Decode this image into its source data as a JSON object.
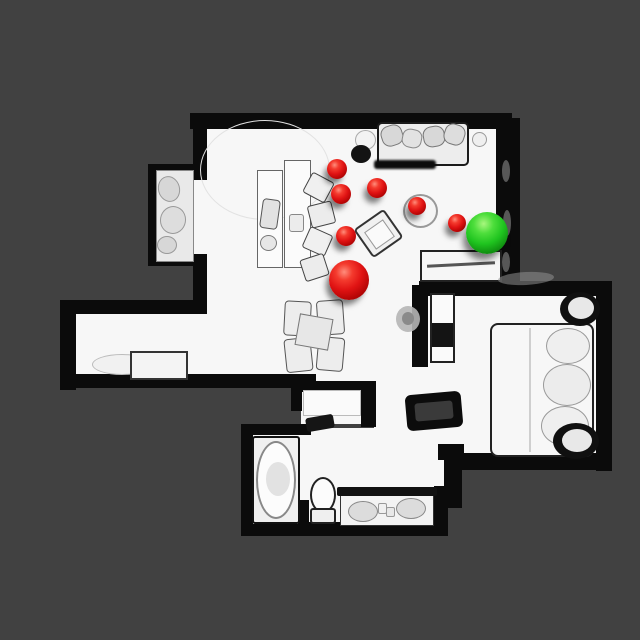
{
  "scene": {
    "type": "top-down-3d-scan-floorplan",
    "background_color": "#414141",
    "floor_color": "#f7f7f7",
    "wall_color": "#0b0b0b",
    "marker_red_color": "#e01313",
    "marker_green_color": "#1fc41f"
  },
  "markers": [
    {
      "name": "waypoint-red-1",
      "color": "red",
      "x": 337,
      "y": 169,
      "r": 10
    },
    {
      "name": "waypoint-red-2",
      "color": "red",
      "x": 341,
      "y": 194,
      "r": 10
    },
    {
      "name": "waypoint-red-3",
      "color": "red",
      "x": 377,
      "y": 188,
      "r": 10
    },
    {
      "name": "waypoint-red-4",
      "color": "red",
      "x": 417,
      "y": 206,
      "r": 9
    },
    {
      "name": "waypoint-red-5",
      "color": "red",
      "x": 457,
      "y": 223,
      "r": 9
    },
    {
      "name": "waypoint-red-6",
      "color": "red",
      "x": 346,
      "y": 236,
      "r": 10
    },
    {
      "name": "waypoint-red-large",
      "color": "red",
      "x": 349,
      "y": 280,
      "r": 20
    },
    {
      "name": "waypoint-green-goal",
      "color": "green",
      "x": 487,
      "y": 233,
      "r": 21
    }
  ],
  "floors": [
    {
      "name": "living-room-floor",
      "x": 198,
      "y": 126,
      "w": 302,
      "h": 256
    },
    {
      "name": "closet-alcove-floor",
      "x": 152,
      "y": 170,
      "w": 46,
      "h": 90
    },
    {
      "name": "hallway-floor",
      "x": 76,
      "y": 312,
      "w": 130,
      "h": 64
    },
    {
      "name": "bedroom-floor",
      "x": 426,
      "y": 294,
      "w": 172,
      "h": 162
    },
    {
      "name": "corridor-floor",
      "x": 374,
      "y": 378,
      "w": 82,
      "h": 84
    },
    {
      "name": "bathroom-floor",
      "x": 300,
      "y": 428,
      "w": 150,
      "h": 78
    },
    {
      "name": "vanity-nook-floor",
      "x": 336,
      "y": 488,
      "w": 100,
      "h": 40
    },
    {
      "name": "tub-room-floor",
      "x": 248,
      "y": 430,
      "w": 100,
      "h": 98
    },
    {
      "name": "closet-room-floor",
      "x": 301,
      "y": 388,
      "w": 64,
      "h": 36
    }
  ],
  "walls": [
    {
      "name": "wall-top",
      "x": 190,
      "y": 113,
      "w": 322,
      "h": 16
    },
    {
      "name": "wall-right-upper",
      "x": 496,
      "y": 118,
      "w": 24,
      "h": 170
    },
    {
      "name": "wall-left-upper",
      "x": 193,
      "y": 118,
      "w": 14,
      "h": 62
    },
    {
      "name": "wall-alcove-top",
      "x": 150,
      "y": 164,
      "w": 50,
      "h": 10
    },
    {
      "name": "wall-alcove-left",
      "x": 148,
      "y": 164,
      "w": 8,
      "h": 102
    },
    {
      "name": "wall-alcove-bottom",
      "x": 150,
      "y": 256,
      "w": 50,
      "h": 10
    },
    {
      "name": "wall-left-mid",
      "x": 193,
      "y": 254,
      "w": 14,
      "h": 60
    },
    {
      "name": "wall-hallway-top",
      "x": 64,
      "y": 300,
      "w": 132,
      "h": 14
    },
    {
      "name": "wall-hallway-left",
      "x": 60,
      "y": 300,
      "w": 16,
      "h": 90
    },
    {
      "name": "wall-hallway-bottom",
      "x": 64,
      "y": 374,
      "w": 252,
      "h": 14
    },
    {
      "name": "wall-closetroom-top",
      "x": 291,
      "y": 381,
      "w": 84,
      "h": 11
    },
    {
      "name": "wall-closetroom-right",
      "x": 361,
      "y": 381,
      "w": 15,
      "h": 46
    },
    {
      "name": "wall-closetroom-left",
      "x": 291,
      "y": 381,
      "w": 11,
      "h": 30
    },
    {
      "name": "wall-bedroom-top",
      "x": 419,
      "y": 281,
      "w": 190,
      "h": 15
    },
    {
      "name": "wall-bedroom-right",
      "x": 596,
      "y": 281,
      "w": 16,
      "h": 190
    },
    {
      "name": "wall-bedroom-left",
      "x": 412,
      "y": 285,
      "w": 16,
      "h": 82
    },
    {
      "name": "wall-bedroom-bottom",
      "x": 450,
      "y": 453,
      "w": 154,
      "h": 17
    },
    {
      "name": "wall-bedroom-step",
      "x": 438,
      "y": 444,
      "w": 26,
      "h": 16
    },
    {
      "name": "wall-tub-top",
      "x": 243,
      "y": 424,
      "w": 68,
      "h": 11
    },
    {
      "name": "wall-tub-left",
      "x": 241,
      "y": 424,
      "w": 12,
      "h": 112
    },
    {
      "name": "wall-tub-bottom",
      "x": 241,
      "y": 524,
      "w": 112,
      "h": 12
    },
    {
      "name": "wall-toilet-left",
      "x": 298,
      "y": 500,
      "w": 11,
      "h": 32
    },
    {
      "name": "wall-toilet-bottom",
      "x": 298,
      "y": 522,
      "w": 48,
      "h": 12
    },
    {
      "name": "wall-vanity-bottom",
      "x": 336,
      "y": 524,
      "w": 112,
      "h": 12
    },
    {
      "name": "wall-vanity-right",
      "x": 434,
      "y": 486,
      "w": 14,
      "h": 50
    },
    {
      "name": "wall-bath-right",
      "x": 444,
      "y": 448,
      "w": 18,
      "h": 60
    }
  ],
  "furniture": [
    {
      "name": "floor-arc",
      "x": 200,
      "y": 120,
      "w": 130,
      "h": 100,
      "kind": "ellipse",
      "fill": "transparent",
      "border": "1px solid #e2e2e2"
    },
    {
      "name": "sofa",
      "x": 377,
      "y": 122,
      "w": 92,
      "h": 44,
      "fill": "#ededed",
      "border": "2px solid #1b1b1b",
      "radius": 5
    },
    {
      "name": "sofa-cushion",
      "x": 381,
      "y": 125,
      "w": 22,
      "h": 21,
      "fill": "#d8d8d8",
      "border": "1px solid #777",
      "radius": "40%",
      "rotate": -18
    },
    {
      "name": "sofa-cushion",
      "x": 402,
      "y": 129,
      "w": 20,
      "h": 19,
      "fill": "#e2e2e2",
      "border": "1px solid #888",
      "radius": "40%",
      "rotate": 12
    },
    {
      "name": "sofa-cushion",
      "x": 423,
      "y": 126,
      "w": 22,
      "h": 21,
      "fill": "#d8d8d8",
      "border": "1px solid #777",
      "radius": "40%",
      "rotate": -10
    },
    {
      "name": "sofa-cushion",
      "x": 444,
      "y": 124,
      "w": 21,
      "h": 21,
      "fill": "#dddddd",
      "border": "1px solid #777",
      "radius": "40%",
      "rotate": 18
    },
    {
      "name": "sofa-shadow",
      "x": 374,
      "y": 160,
      "w": 62,
      "h": 9,
      "fill": "#0d0d0d",
      "blur": 1,
      "radius": 3
    },
    {
      "name": "side-knob",
      "x": 472,
      "y": 132,
      "w": 15,
      "h": 15,
      "kind": "ellipse",
      "fill": "#efefef",
      "border": "1px solid #999"
    },
    {
      "name": "floor-lamp-globe",
      "x": 355,
      "y": 130,
      "w": 21,
      "h": 20,
      "kind": "ellipse",
      "fill": "#f3f3f3",
      "border": "1px solid #aaa"
    },
    {
      "name": "floor-lamp-shadow",
      "x": 351,
      "y": 145,
      "w": 20,
      "h": 18,
      "kind": "ellipse",
      "fill": "#131313"
    },
    {
      "name": "desk-panel",
      "x": 257,
      "y": 170,
      "w": 26,
      "h": 98,
      "fill": "#fbfbfb",
      "border": "1px solid #666"
    },
    {
      "name": "desk-panel",
      "x": 284,
      "y": 160,
      "w": 27,
      "h": 108,
      "fill": "#fbfbfb",
      "border": "1px solid #666"
    },
    {
      "name": "desk-chair",
      "x": 261,
      "y": 199,
      "w": 18,
      "h": 30,
      "fill": "#e2e2e2",
      "border": "1px solid #555",
      "radius": 4,
      "rotate": 8
    },
    {
      "name": "desk-item",
      "x": 289,
      "y": 214,
      "w": 15,
      "h": 18,
      "fill": "#ececec",
      "border": "1px solid #888",
      "radius": 3
    },
    {
      "name": "desk-item-round",
      "x": 260,
      "y": 235,
      "w": 17,
      "h": 16,
      "kind": "ellipse",
      "fill": "#e6e6e6",
      "border": "1px solid #777"
    },
    {
      "name": "office-chair",
      "x": 306,
      "y": 176,
      "w": 25,
      "h": 23,
      "fill": "#f0f0f0",
      "border": "1px solid #444",
      "radius": 3,
      "rotate": 28
    },
    {
      "name": "office-chair",
      "x": 309,
      "y": 203,
      "w": 25,
      "h": 23,
      "fill": "#ececec",
      "border": "1px solid #444",
      "radius": 3,
      "rotate": -14
    },
    {
      "name": "office-chair",
      "x": 305,
      "y": 230,
      "w": 25,
      "h": 23,
      "fill": "#f0f0f0",
      "border": "1px solid #444",
      "radius": 3,
      "rotate": 24
    },
    {
      "name": "office-chair",
      "x": 302,
      "y": 256,
      "w": 25,
      "h": 23,
      "fill": "#ececec",
      "border": "1px solid #444",
      "radius": 3,
      "rotate": -18
    },
    {
      "name": "round-side-table",
      "x": 403,
      "y": 194,
      "w": 35,
      "h": 34,
      "kind": "ellipse",
      "fill": "#f5f5f5",
      "border": "2px solid #999"
    },
    {
      "name": "armchair",
      "x": 360,
      "y": 216,
      "w": 37,
      "h": 35,
      "fill": "#f1f1f1",
      "border": "2px solid #333",
      "radius": 4,
      "rotate": -35
    },
    {
      "name": "armchair-seat",
      "x": 368,
      "y": 224,
      "w": 23,
      "h": 21,
      "fill": "#fafafa",
      "border": "1px solid #999",
      "rotate": -35
    },
    {
      "name": "dining-chair",
      "x": 284,
      "y": 301,
      "w": 27,
      "h": 35,
      "fill": "#ededed",
      "border": "1px solid #555",
      "radius": 4,
      "rotate": 3
    },
    {
      "name": "dining-chair",
      "x": 317,
      "y": 300,
      "w": 27,
      "h": 35,
      "fill": "#ededed",
      "border": "1px solid #555",
      "radius": 4,
      "rotate": -4
    },
    {
      "name": "dining-chair",
      "x": 285,
      "y": 338,
      "w": 27,
      "h": 34,
      "fill": "#ededed",
      "border": "1px solid #555",
      "radius": 4,
      "rotate": -6
    },
    {
      "name": "dining-chair",
      "x": 317,
      "y": 337,
      "w": 27,
      "h": 34,
      "fill": "#ededed",
      "border": "1px solid #555",
      "radius": 4,
      "rotate": 5
    },
    {
      "name": "dining-table",
      "x": 297,
      "y": 316,
      "w": 34,
      "h": 32,
      "fill": "#e7e7e7",
      "border": "1px solid #777",
      "rotate": 10
    },
    {
      "name": "console-table",
      "x": 420,
      "y": 250,
      "w": 82,
      "h": 32,
      "fill": "#f6f6f6",
      "border": "2px solid #222"
    },
    {
      "name": "console-stick",
      "x": 427,
      "y": 263,
      "w": 68,
      "h": 3,
      "fill": "#555",
      "rotate": -3
    },
    {
      "name": "alcove-shelf",
      "x": 156,
      "y": 170,
      "w": 38,
      "h": 92,
      "fill": "#e9e9e9",
      "border": "1px solid #888"
    },
    {
      "name": "alcove-item",
      "x": 158,
      "y": 176,
      "w": 22,
      "h": 26,
      "kind": "ellipse",
      "fill": "#d7d7d7",
      "border": "1px solid #999",
      "rotate": -15
    },
    {
      "name": "alcove-item",
      "x": 160,
      "y": 206,
      "w": 26,
      "h": 28,
      "kind": "ellipse",
      "fill": "#dddddd",
      "border": "1px solid #999",
      "rotate": 10
    },
    {
      "name": "alcove-item",
      "x": 157,
      "y": 236,
      "w": 20,
      "h": 18,
      "kind": "ellipse",
      "fill": "#d7d7d7",
      "border": "1px solid #999"
    },
    {
      "name": "hallway-rug",
      "x": 92,
      "y": 354,
      "w": 60,
      "h": 21,
      "kind": "ellipse",
      "fill": "#f1f1f1",
      "border": "1px solid #bbb"
    },
    {
      "name": "hallway-bench",
      "x": 130,
      "y": 351,
      "w": 58,
      "h": 29,
      "fill": "#f4f4f4",
      "border": "2px solid #333",
      "class": "quilt"
    },
    {
      "name": "bed",
      "x": 490,
      "y": 323,
      "w": 104,
      "h": 134,
      "fill": "#f7f7f7",
      "border": "2px solid #222",
      "radius": 8
    },
    {
      "name": "bed-fold-line",
      "x": 529,
      "y": 328,
      "w": 2,
      "h": 124,
      "fill": "#cfcfcf"
    },
    {
      "name": "bed-pillow",
      "x": 546,
      "y": 328,
      "w": 44,
      "h": 36,
      "kind": "ellipse",
      "fill": "#efefef",
      "border": "1px solid #999"
    },
    {
      "name": "bed-pillow",
      "x": 543,
      "y": 364,
      "w": 48,
      "h": 42,
      "kind": "ellipse",
      "fill": "#ececec",
      "border": "1px solid #999"
    },
    {
      "name": "bed-pillow",
      "x": 541,
      "y": 406,
      "w": 48,
      "h": 40,
      "kind": "ellipse",
      "fill": "#efefef",
      "border": "1px solid #999"
    },
    {
      "name": "bedside-shadow-top",
      "x": 560,
      "y": 292,
      "w": 40,
      "h": 34,
      "kind": "ellipse",
      "fill": "#101010"
    },
    {
      "name": "bedside-table-top",
      "x": 568,
      "y": 297,
      "w": 26,
      "h": 22,
      "kind": "ellipse",
      "fill": "#e8e8e8"
    },
    {
      "name": "bedside-shadow-bottom",
      "x": 553,
      "y": 423,
      "w": 46,
      "h": 36,
      "kind": "ellipse",
      "fill": "#101010"
    },
    {
      "name": "bedside-table-bottom",
      "x": 562,
      "y": 429,
      "w": 30,
      "h": 23,
      "kind": "ellipse",
      "fill": "#e8e8e8"
    },
    {
      "name": "wardrobe",
      "x": 430,
      "y": 293,
      "w": 25,
      "h": 70,
      "fill": "#fafafa",
      "border": "2px solid #222"
    },
    {
      "name": "wardrobe-dark-panel",
      "x": 432,
      "y": 323,
      "w": 21,
      "h": 24,
      "fill": "#141414"
    },
    {
      "name": "potted-plant",
      "x": 396,
      "y": 306,
      "w": 24,
      "h": 26,
      "kind": "ellipse",
      "fill": "#b5b5b5",
      "opacity": 0.9
    },
    {
      "name": "potted-plant-core",
      "x": 402,
      "y": 312,
      "w": 12,
      "h": 13,
      "kind": "ellipse",
      "fill": "#8a8a8a"
    },
    {
      "name": "luggage-bench",
      "x": 406,
      "y": 393,
      "w": 56,
      "h": 36,
      "fill": "#0c0c0c",
      "radius": 6,
      "rotate": -5
    },
    {
      "name": "luggage-bench-inner",
      "x": 415,
      "y": 402,
      "w": 38,
      "h": 18,
      "fill": "#3a3a3a",
      "radius": 3,
      "rotate": -5
    },
    {
      "name": "wall-clutter",
      "x": 498,
      "y": 272,
      "w": 56,
      "h": 13,
      "kind": "ellipse",
      "fill": "#8f8f8f",
      "opacity": 0.55,
      "rotate": -3
    },
    {
      "name": "bathtub",
      "x": 252,
      "y": 436,
      "w": 48,
      "h": 88,
      "fill": "#f0f0f0",
      "border": "2px solid #111",
      "radius": 3
    },
    {
      "name": "bathtub-basin",
      "x": 256,
      "y": 441,
      "w": 40,
      "h": 78,
      "kind": "ellipse",
      "fill": "#fcfcfc",
      "border": "2px solid #888"
    },
    {
      "name": "bathtub-shade",
      "x": 266,
      "y": 462,
      "w": 24,
      "h": 34,
      "kind": "ellipse",
      "fill": "#e2e2e2"
    },
    {
      "name": "toilet",
      "x": 310,
      "y": 477,
      "w": 26,
      "h": 36,
      "kind": "ellipse",
      "fill": "#fcfcfc",
      "border": "2px solid #222"
    },
    {
      "name": "toilet-base",
      "x": 310,
      "y": 508,
      "w": 26,
      "h": 16,
      "fill": "#efefef",
      "border": "2px solid #222",
      "radius": 3
    },
    {
      "name": "vanity-counter",
      "x": 340,
      "y": 490,
      "w": 94,
      "h": 36,
      "fill": "#f3f3f3",
      "border": "1px solid #333"
    },
    {
      "name": "vanity-counter-edge",
      "x": 337,
      "y": 487,
      "w": 100,
      "h": 9,
      "fill": "#111111",
      "radius": 2
    },
    {
      "name": "sink",
      "x": 348,
      "y": 501,
      "w": 30,
      "h": 21,
      "kind": "ellipse",
      "fill": "#dcdcdc",
      "border": "1px solid #888"
    },
    {
      "name": "sink",
      "x": 396,
      "y": 498,
      "w": 30,
      "h": 21,
      "kind": "ellipse",
      "fill": "#dcdcdc",
      "border": "1px solid #888"
    },
    {
      "name": "vanity-item",
      "x": 378,
      "y": 503,
      "w": 9,
      "h": 11,
      "fill": "#f0f0f0",
      "border": "1px solid #999",
      "radius": 2
    },
    {
      "name": "vanity-item",
      "x": 386,
      "y": 507,
      "w": 9,
      "h": 10,
      "fill": "#e8e8e8",
      "border": "1px solid #999",
      "radius": 2
    },
    {
      "name": "closet-door-panel",
      "x": 303,
      "y": 390,
      "w": 58,
      "h": 26,
      "fill": "#fafafa",
      "border": "1px solid #bbb"
    },
    {
      "name": "door-swing-shadow",
      "x": 306,
      "y": 416,
      "w": 28,
      "h": 14,
      "fill": "#151515",
      "radius": 3,
      "rotate": -10
    },
    {
      "name": "wall-texture-mark",
      "x": 502,
      "y": 160,
      "w": 8,
      "h": 22,
      "kind": "ellipse",
      "fill": "#8a8a8a",
      "opacity": 0.6
    },
    {
      "name": "wall-texture-mark",
      "x": 503,
      "y": 210,
      "w": 8,
      "h": 26,
      "kind": "ellipse",
      "fill": "#8a8a8a",
      "opacity": 0.6
    },
    {
      "name": "wall-texture-mark",
      "x": 502,
      "y": 252,
      "w": 8,
      "h": 20,
      "kind": "ellipse",
      "fill": "#8a8a8a",
      "opacity": 0.6
    }
  ]
}
